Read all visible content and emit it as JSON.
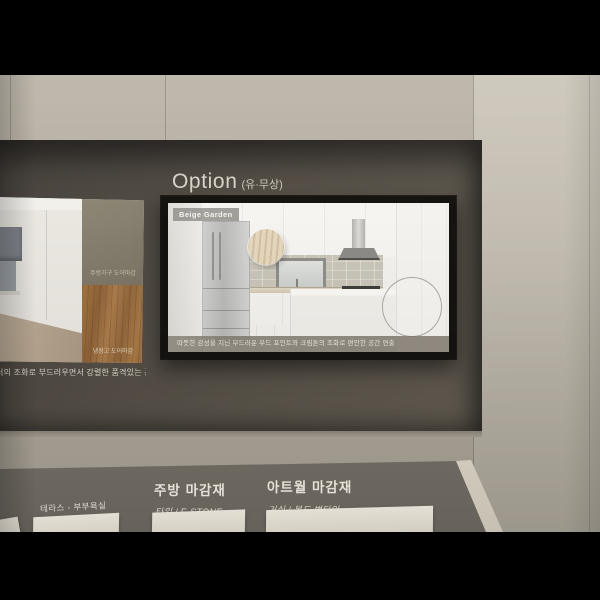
{
  "palette": {
    "wall": "#b2ab9f",
    "wall_right": "#c6c0b4",
    "niche": "#544e46",
    "board": "#7c766d",
    "tv_frame": "#151310",
    "screen_bg": "#f1f0ec",
    "wood_swatch": "#9b6f44",
    "letterbox": "#000000"
  },
  "option": {
    "title": "Option",
    "subtitle": "(유·무상)"
  },
  "tv": {
    "badge": "Beige Garden",
    "caption": "따뜻한 감성을 지닌 부드러운 우드 포인트와 크림톤의 조화로 편안한 공간 연출"
  },
  "sample_panel": {
    "swatch_top_label": "주방가구 도어마감",
    "swatch_bottom_label": "냉장고 도어마감",
    "caption": "러의 조화로 부드러우면서 강렬한 품격있는 공간 연출"
  },
  "board": {
    "terrace_label": "테라스 - 부부욕실",
    "sections": [
      {
        "title": "주방 마감재",
        "subtitle": "타일 / E-STONE"
      },
      {
        "title": "아트월 마감재",
        "subtitle": "거실 / 복도 벽타일"
      }
    ]
  }
}
